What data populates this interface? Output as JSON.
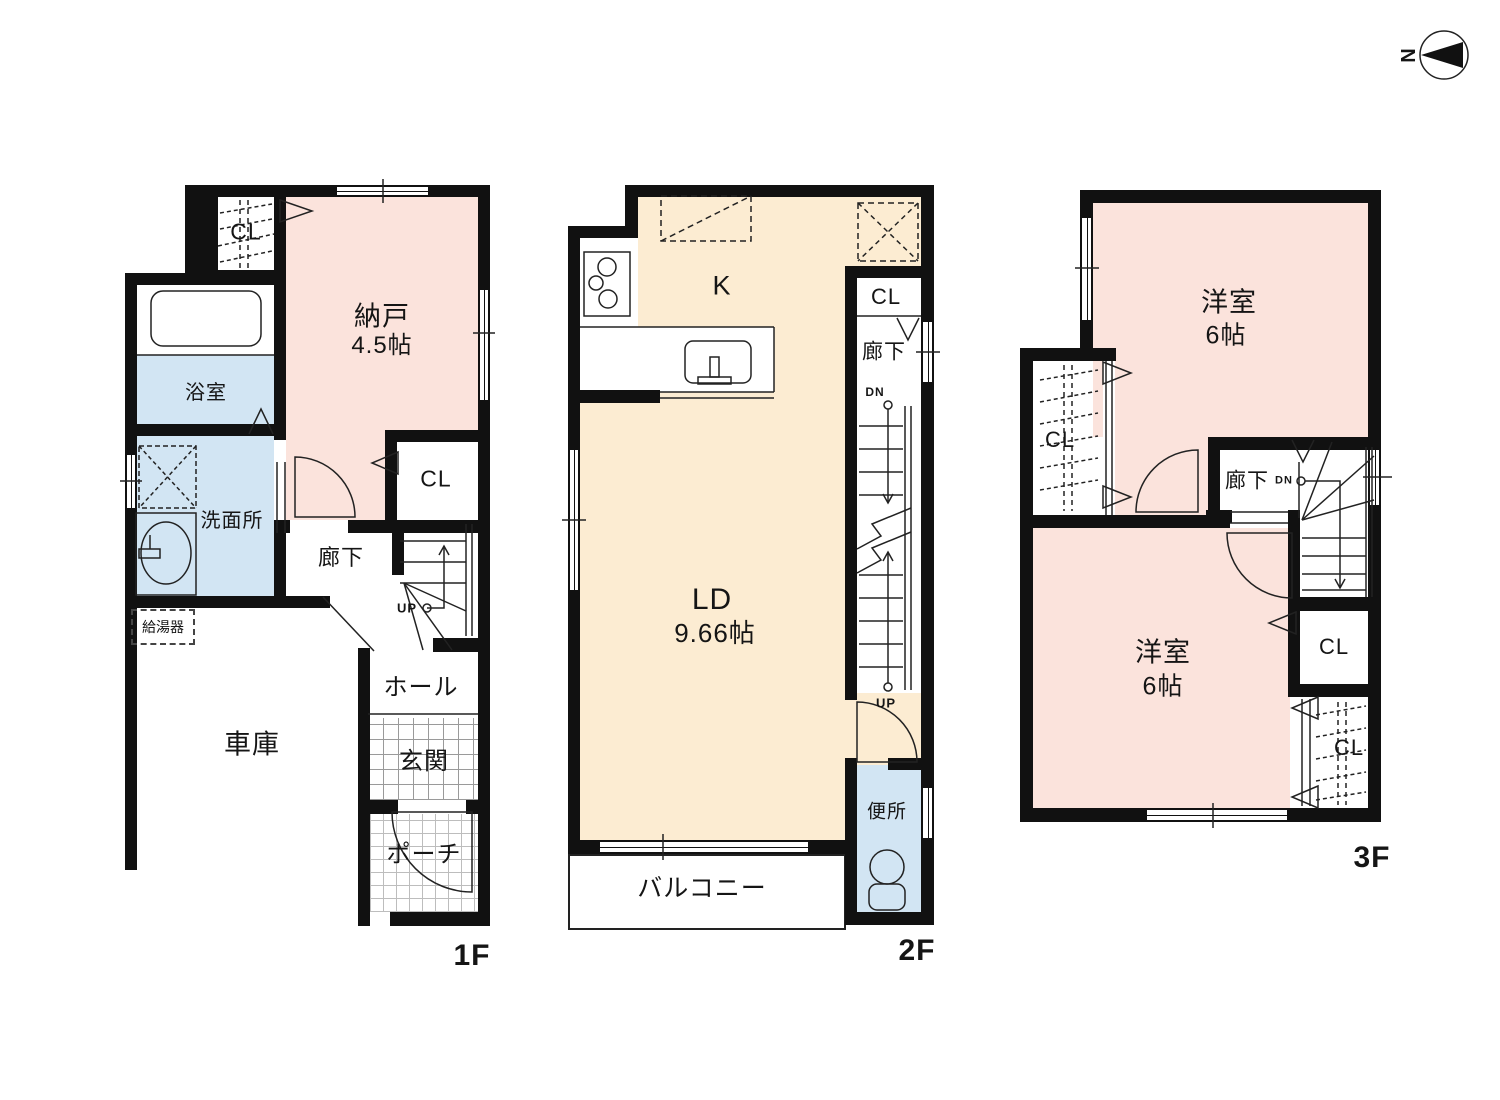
{
  "compass": {
    "north_label": "N"
  },
  "colors": {
    "wall": "#111111",
    "pink": "#fbe3dc",
    "cream": "#fcecd2",
    "blue": "#d2e5f3"
  },
  "floors": {
    "f1": {
      "label": "1F",
      "rooms": {
        "closet_top": {
          "label": "CL"
        },
        "storage": {
          "name": "納戸",
          "size": "4.5帖"
        },
        "bathroom": {
          "name": "浴室"
        },
        "washroom": {
          "name": "洗面所"
        },
        "corridor": {
          "name": "廊下"
        },
        "closet_side": {
          "label": "CL"
        },
        "stairs": {
          "up_label": "UP"
        },
        "hall": {
          "name": "ホール"
        },
        "entrance": {
          "name": "玄関"
        },
        "porch": {
          "name": "ポーチ"
        },
        "garage": {
          "name": "車庫"
        },
        "water_heater": {
          "name": "給湯器"
        }
      }
    },
    "f2": {
      "label": "2F",
      "rooms": {
        "kitchen": {
          "name": "K"
        },
        "closet": {
          "label": "CL"
        },
        "corridor": {
          "name": "廊下"
        },
        "stairs": {
          "dn_label": "DN",
          "up_label": "UP"
        },
        "living_dining": {
          "name": "LD",
          "size": "9.66帖"
        },
        "toilet": {
          "name": "便所"
        },
        "balcony": {
          "name": "バルコニー"
        }
      }
    },
    "f3": {
      "label": "3F",
      "rooms": {
        "bedroom_top": {
          "name": "洋室",
          "size": "6帖"
        },
        "closet_left": {
          "label": "CL"
        },
        "corridor": {
          "name": "廊下",
          "dn_label": "DN"
        },
        "bedroom_bottom": {
          "name": "洋室",
          "size": "6帖"
        },
        "closet_mid": {
          "label": "CL"
        },
        "closet_corner": {
          "label": "CL"
        }
      }
    }
  }
}
